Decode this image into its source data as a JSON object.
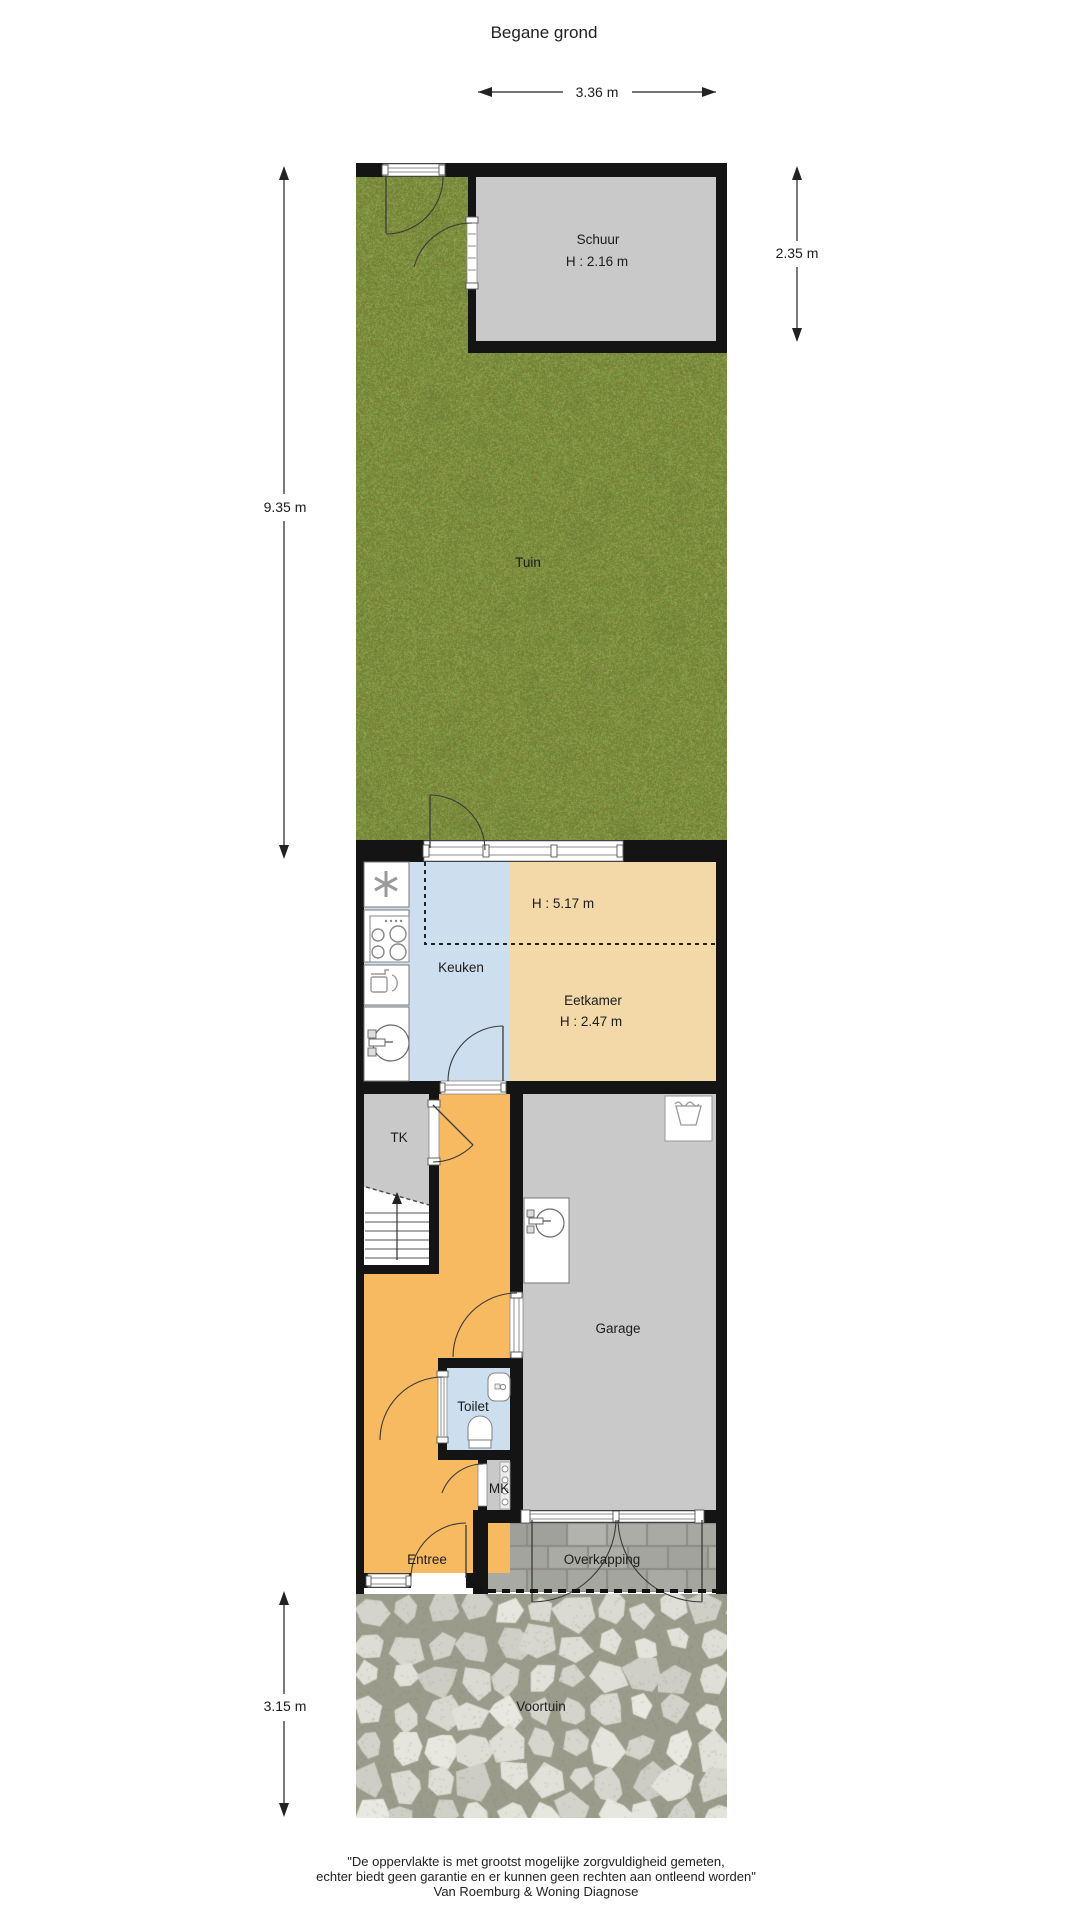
{
  "title": "Begane grond",
  "rooms": {
    "schuur": {
      "label": "Schuur",
      "height": "H : 2.16 m"
    },
    "tuin": {
      "label": "Tuin"
    },
    "keuken": {
      "label": "Keuken"
    },
    "void_zone": {
      "height": "H : 5.17 m"
    },
    "eetkamer": {
      "label": "Eetkamer",
      "height": "H : 2.47 m"
    },
    "tk": {
      "label": "TK"
    },
    "garage": {
      "label": "Garage"
    },
    "toilet": {
      "label": "Toilet"
    },
    "mk": {
      "label": "MK"
    },
    "entree": {
      "label": "Entree"
    },
    "overkapping": {
      "label": "Overkapping"
    },
    "voortuin": {
      "label": "Voortuin"
    }
  },
  "dimensions": {
    "top_width": "3.36 m",
    "schuur_depth": "2.35 m",
    "tuin_depth": "9.35 m",
    "voortuin_depth": "3.15 m"
  },
  "footer": {
    "line1": "\"De oppervlakte is met grootst mogelijke zorgvuldigheid gemeten,",
    "line2": "echter biedt geen garantie en er kunnen geen rechten aan ontleend worden\"",
    "line3": "Van Roemburg & Woning Diagnose"
  },
  "colors": {
    "wall": "#141414",
    "room_grey": "#c9c9c9",
    "kitchen_blue": "#cddfee",
    "dining_tan": "#f3d9a8",
    "hall_orange": "#f8ba61",
    "grass_base": "#7c9143",
    "stone_mortar": "#9b9b8b",
    "brick_mortar": "#8d8b84"
  }
}
